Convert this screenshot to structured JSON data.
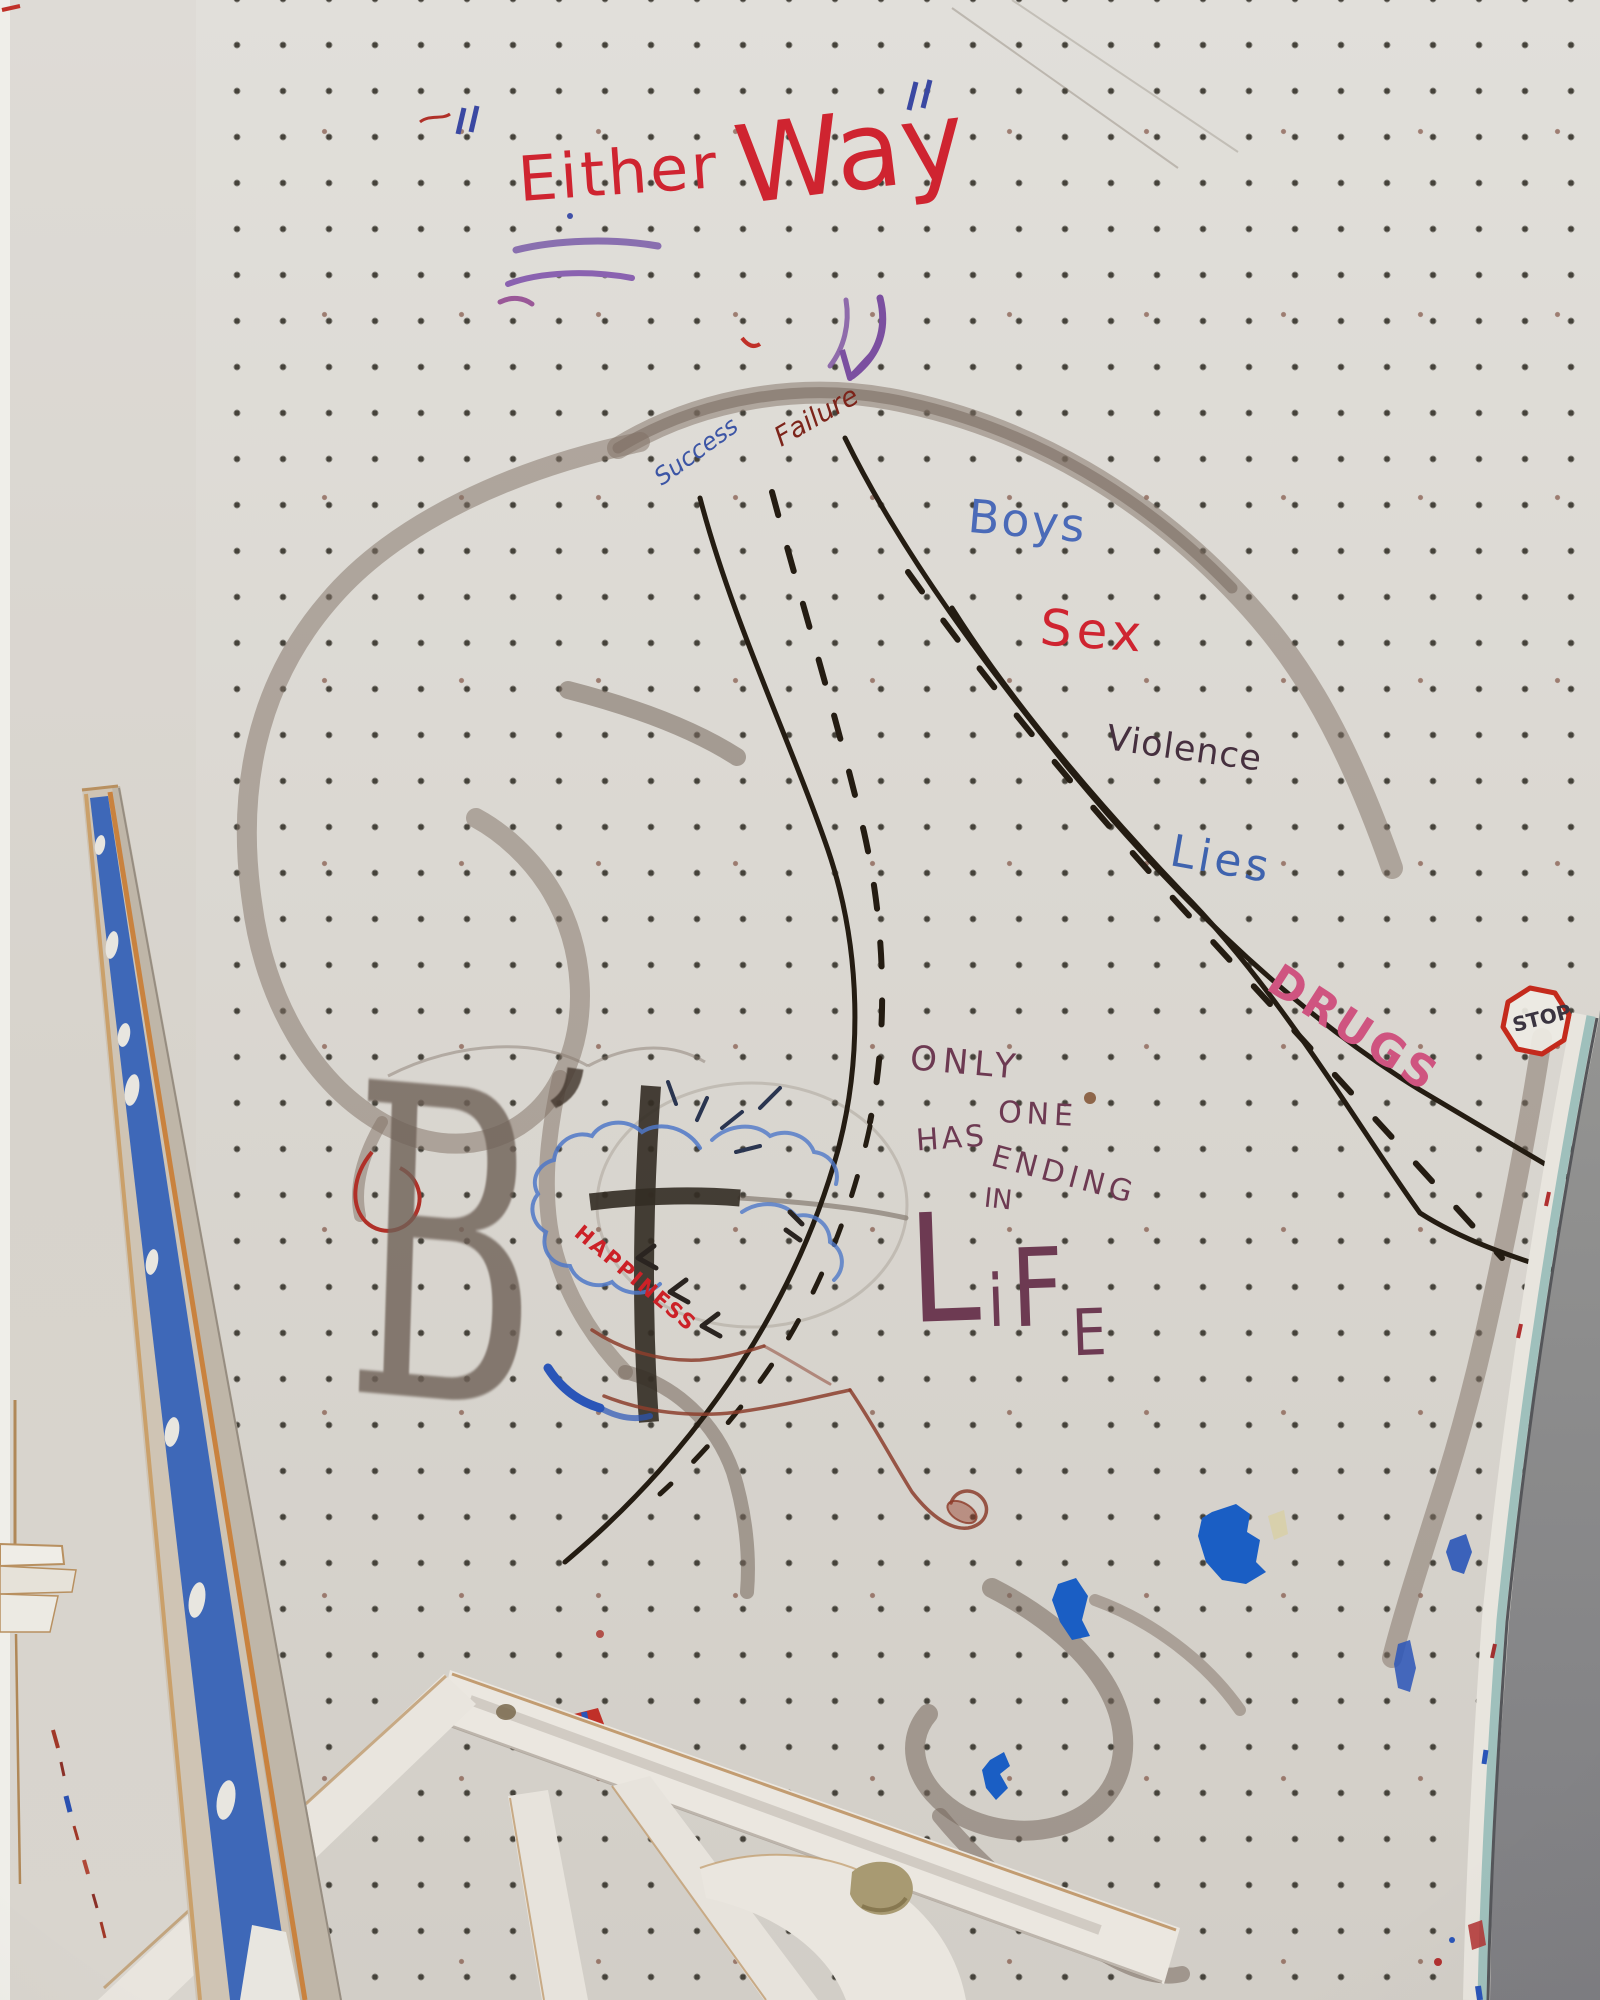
{
  "scene": {
    "alt": "Photograph of a white pegboard wall covered with hand-painted graffiti showing a forking road of life choices, with a leaning painted board and white window frames at the bottom",
    "title_word1": "Either",
    "title_word2": "Way"
  },
  "labels": {
    "success": "Success",
    "failure": "Failure",
    "boys": "Boys",
    "sex": "Sex",
    "violence": "Violence",
    "lies": "Lies",
    "drugs": "DRUGS",
    "happiness": "HAPPINESS",
    "stop": "STOP"
  },
  "message": {
    "only": "ONLY",
    "one": "ONE",
    "has": "HAS",
    "ending": "ENDING",
    "in": "IN",
    "life_letters": [
      "L",
      "i",
      "F",
      "E"
    ]
  },
  "big_letter": {
    "letter": "B",
    "apostrophe": "’"
  },
  "colors": {
    "red": "#cf2430",
    "dark_red": "#7c241a",
    "blue": "#3f63ae",
    "light_blue": "#4a6ab8",
    "purple": "#7b4fa0",
    "pink": "#cf5480",
    "maroon": "#6d3a52",
    "ink_black": "#241c12",
    "splotch_blue": "#1a5ec4",
    "board_blue": "#3e68b8",
    "smudge_gray": "#80705f",
    "wall_gray": "#8c8c8c"
  }
}
